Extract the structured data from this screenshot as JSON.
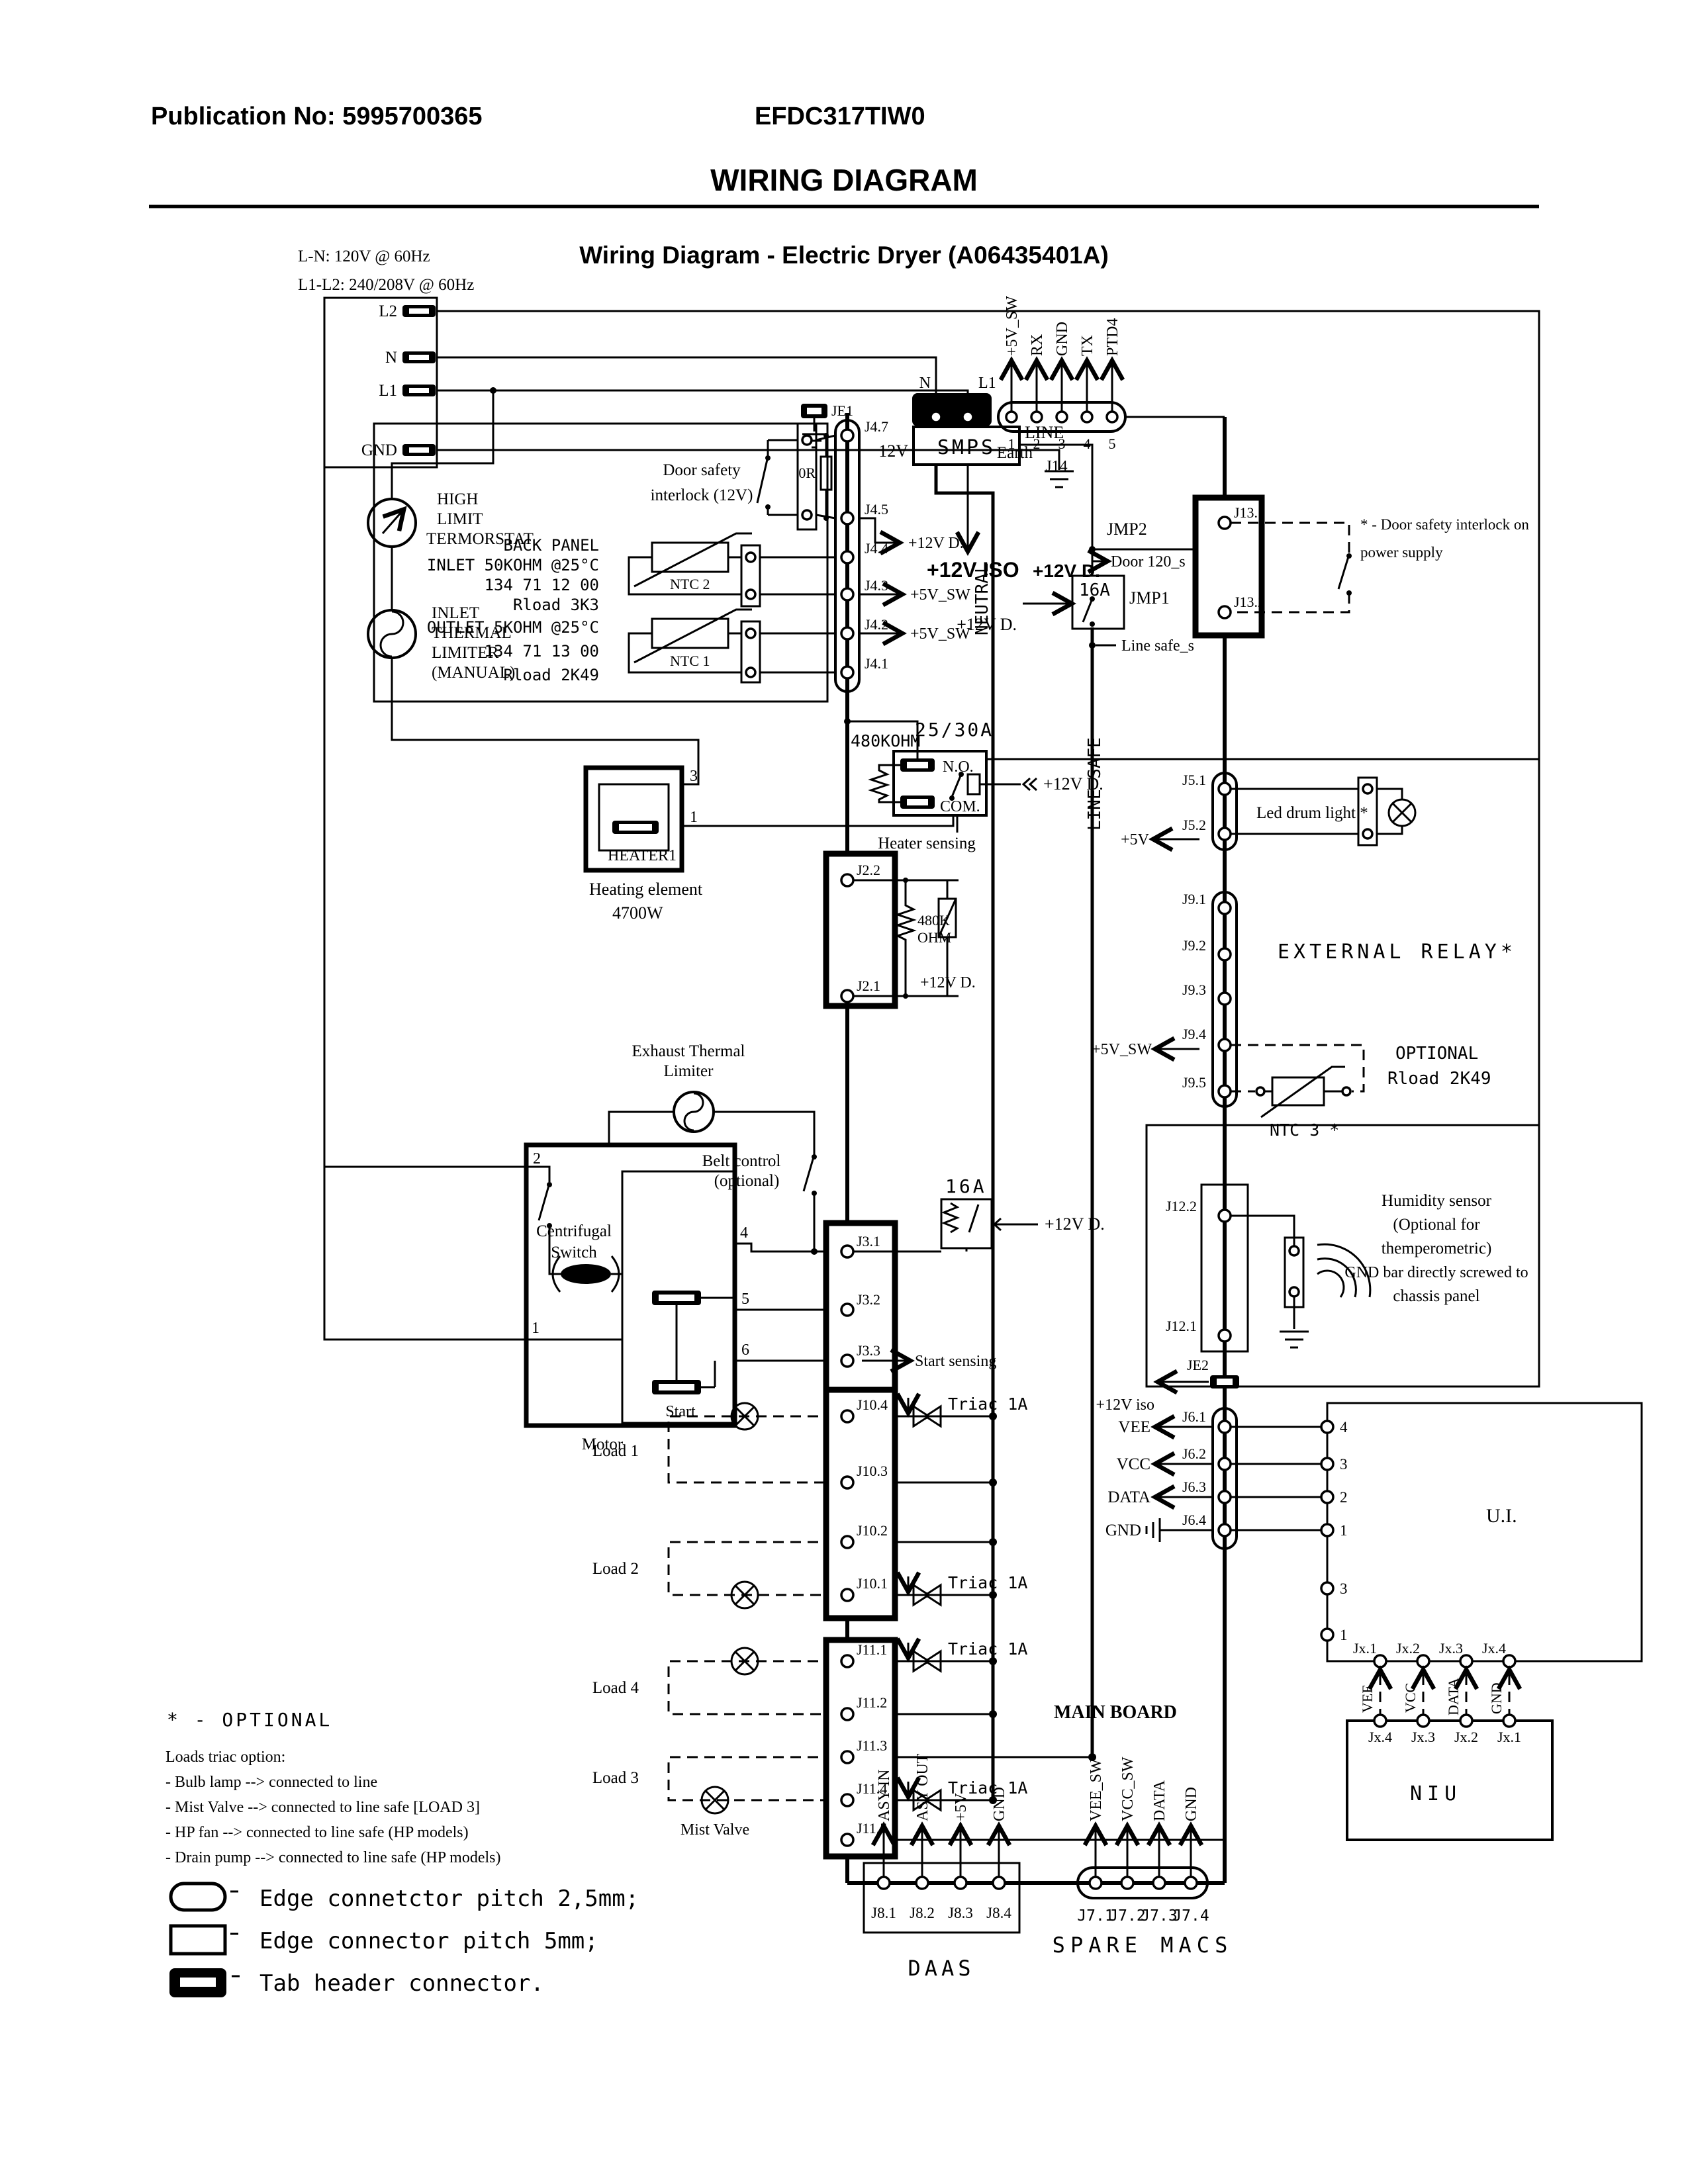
{
  "colors": {
    "ink": "#000000",
    "paper": "#ffffff"
  },
  "header": {
    "publication": "Publication No: 5995700365",
    "model": "EFDC317TIW0",
    "title": "WIRING DIAGRAM",
    "subtitle": "Wiring Diagram - Electric Dryer (A06435401A)"
  },
  "power": {
    "ln": "L-N: 120V @ 60Hz",
    "l1l2": "L1-L2: 240/208V @ 60Hz",
    "l2": "L2",
    "n": "N",
    "l1": "L1",
    "gnd": "GND",
    "earth": "Earth"
  },
  "nets": {
    "v5sw": "+5V_SW",
    "v5": "+5V",
    "v12d": "+12V D.",
    "v12iso": "+12V ISO",
    "v12iso_lc": "+12V iso",
    "neutral": "NEUTRAL",
    "line_safe": "LINE SAFE",
    "line_safe_s": "Line safe_s",
    "door120": "Door 120_s"
  },
  "smps": {
    "label": "SMPS",
    "v12": "12V",
    "line": "LINE",
    "j1_1": "J1.1",
    "j1_2": "J1.2",
    "n": "N",
    "l1": "L1"
  },
  "j14": {
    "label": "J14",
    "pins": [
      "1",
      "2",
      "3",
      "4",
      "5"
    ],
    "signals": [
      "+5V_SW",
      "RX",
      "GND",
      "TX",
      "PTD4"
    ]
  },
  "jumpers": {
    "jmp1": "JMP1",
    "jmp2": "JMP2",
    "a16": "16A"
  },
  "j13": {
    "p1": "J13.1",
    "p2": "J13.2",
    "note1": "* - Door safety interlock on",
    "note2": "power supply"
  },
  "j4": {
    "pins": [
      "J4.7",
      "J4.5",
      "J4.4",
      "J4.3",
      "J4.2",
      "J4.1"
    ],
    "je1": "JE1",
    "r0": "0R"
  },
  "door": {
    "l1": "Door safety",
    "l2": "interlock (12V)"
  },
  "left": {
    "high": [
      "HIGH",
      "LIMIT",
      "TERMORSTAT"
    ],
    "inlet": [
      "INLET",
      "THERMAL",
      "LIMITER",
      "(MANUAL)"
    ],
    "back": [
      "BACK PANEL",
      "INLET 50KOHM @25°C",
      "134 71 12 00",
      "Rload 3K3"
    ],
    "ntc2": "NTC 2",
    "outlet": [
      "OUTLET 5KOHM @25°C",
      "134 71 13 00",
      "Rload 2K49"
    ],
    "ntc1": "NTC 1"
  },
  "relay": {
    "r": "480KOHM",
    "amp": "25/30A",
    "no": "N.O.",
    "com": "COM.",
    "sense": "Heater sensing"
  },
  "heater": {
    "name": "HEATER1",
    "p3": "3",
    "p1": "1",
    "cap1": "Heating element",
    "cap2": "4700W"
  },
  "j2": {
    "p2": "J2.2",
    "p1": "J2.1",
    "r1": "480K",
    "r2": "OHM"
  },
  "j5": {
    "p1": "J5.1",
    "p2": "J5.2",
    "cap": "Led drum light *"
  },
  "j9": {
    "pins": [
      "J9.1",
      "J9.2",
      "J9.3",
      "J9.4",
      "J9.5"
    ],
    "cap": "EXTERNAL RELAY*",
    "ntc3": "NTC 3 *",
    "opt1": "OPTIONAL",
    "opt2": "Rload 2K49"
  },
  "motor": {
    "exh1": "Exhaust Thermal",
    "exh2": "Limiter",
    "belt1": "Belt control",
    "belt2": "(optional)",
    "cent1": "Centrifugal",
    "cent2": "Switch",
    "start": "Start",
    "name": "Motor",
    "p1": "1",
    "p2": "2",
    "p4": "4",
    "p5": "5",
    "p6": "6"
  },
  "j3": {
    "pins": [
      "J3.1",
      "J3.2",
      "J3.3"
    ],
    "sense": "Start sensing",
    "a16": "16A"
  },
  "j12": {
    "p2": "J12.2",
    "p1": "J12.1",
    "je2": "JE2",
    "hum": [
      "Humidity sensor",
      "(Optional for",
      "themperometric)",
      "GND bar directly screwed to",
      "chassis panel"
    ]
  },
  "loads": {
    "l1": "Load 1",
    "l2": "Load 2",
    "l4": "Load 4",
    "l3": "Load 3",
    "mist": "Mist Valve",
    "triac": "Triac 1A"
  },
  "j10": {
    "pins": [
      "J10.4",
      "J10.3",
      "J10.2",
      "J10.1"
    ]
  },
  "j11": {
    "pins": [
      "J11.1",
      "J11.2",
      "J11.3",
      "J11.4",
      "J11.5"
    ]
  },
  "board": {
    "label": "MAIN BOARD"
  },
  "j6": {
    "pins": [
      "J6.1",
      "J6.2",
      "J6.3",
      "J6.4"
    ],
    "signals": [
      "VEE",
      "VCC",
      "DATA",
      "GND"
    ]
  },
  "ui": {
    "name": "U.I.",
    "right": [
      "4",
      "3",
      "2",
      "1"
    ],
    "lower": [
      "3",
      "1"
    ],
    "jx": [
      "Jx.1",
      "Jx.2",
      "Jx.3",
      "Jx.4"
    ]
  },
  "niu": {
    "name": "NIU",
    "jx": [
      "Jx.4",
      "Jx.3",
      "Jx.2",
      "Jx.1"
    ],
    "signals": [
      "VEE",
      "VCC",
      "DATA",
      "GND"
    ]
  },
  "j8": {
    "name": "DAAS",
    "pins": [
      "J8.1",
      "J8.2",
      "J8.3",
      "J8.4"
    ],
    "signals": [
      "ASY IN",
      "ASY OUT",
      "+5V",
      "GND"
    ]
  },
  "j7": {
    "name": "SPARE MACS",
    "pins": [
      "J7.1",
      "J7.2",
      "J7.3",
      "J7.4"
    ],
    "signals": [
      "VEE_SW",
      "VCC_SW",
      "DATA",
      "GND"
    ]
  },
  "notes": {
    "opt": "* - OPTIONAL",
    "title": "Loads triac option:",
    "items": [
      "- Bulb lamp --> connected to line",
      "- Mist Valve --> connected to line safe [LOAD 3]",
      "- HP fan --> connected to line safe (HP models)",
      "- Drain pump --> connected to line safe (HP models)"
    ]
  },
  "legend": [
    "Edge connetctor pitch 2,5mm;",
    "Edge connector pitch 5mm;",
    "Tab header connector."
  ]
}
